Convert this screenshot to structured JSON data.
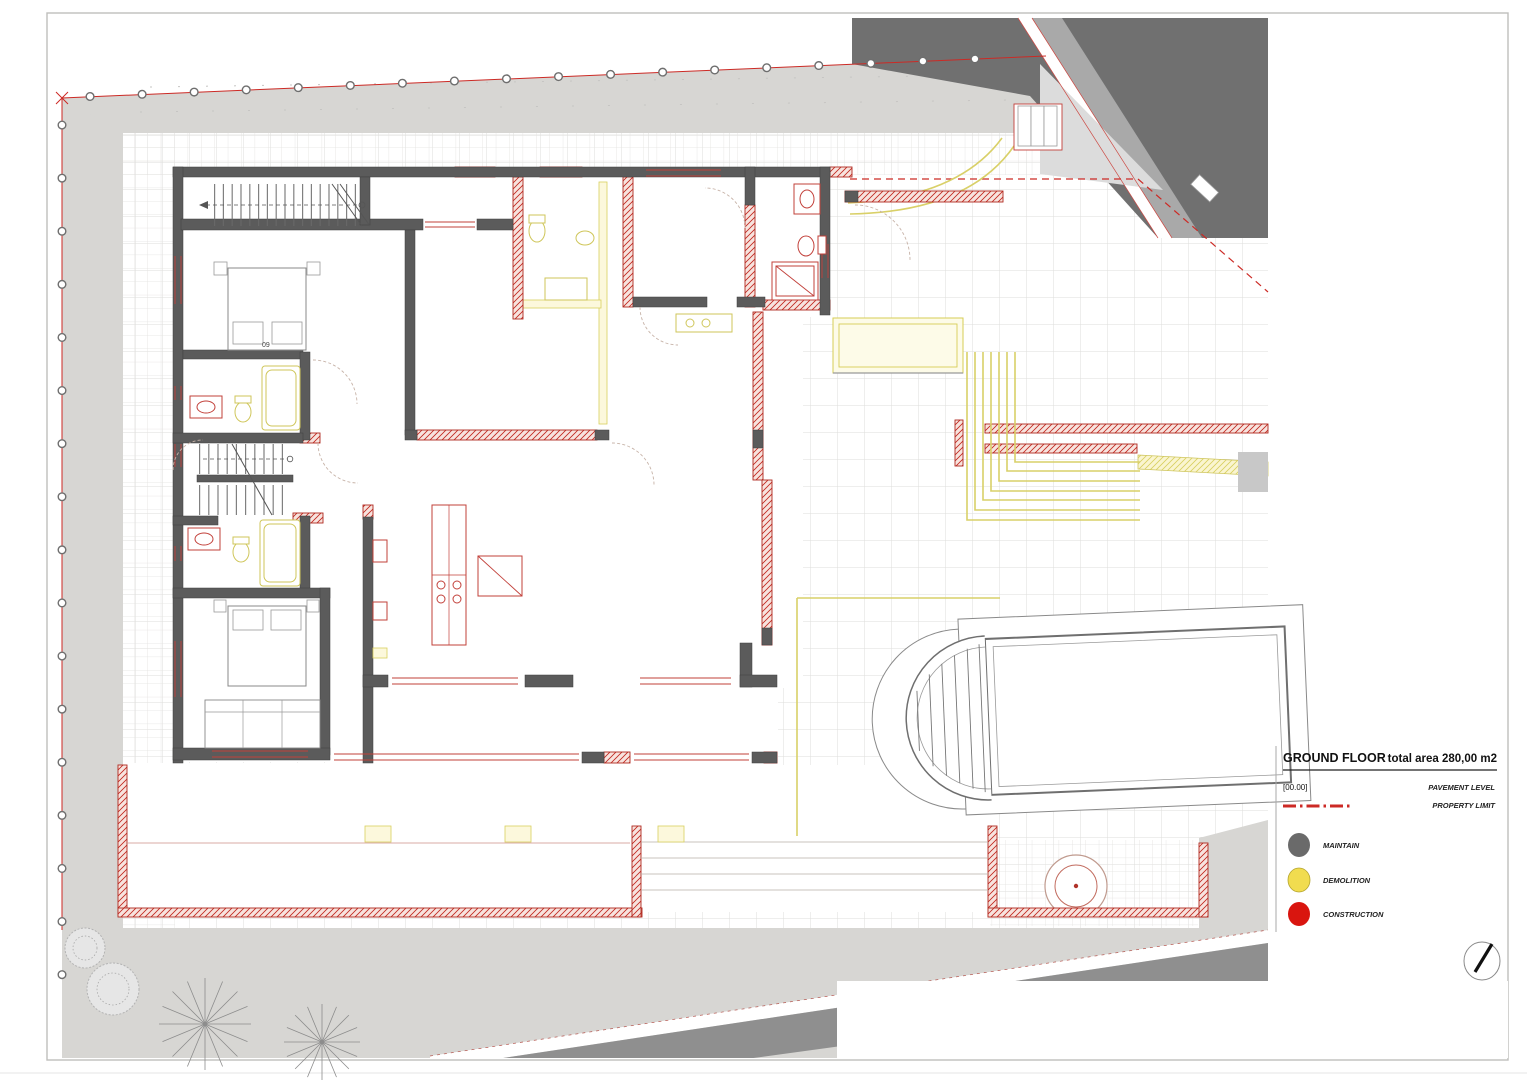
{
  "drawing": {
    "title": "GROUND FLOOR",
    "total_area": "total area 280,00 m2",
    "pavement_code": "[00.00]",
    "pavement_label": "PAVEMENT LEVEL",
    "property_limit_label": "PROPERTY LIMIT",
    "room_number": "09"
  },
  "legend": {
    "items": [
      {
        "id": "maintain",
        "label": "MAINTAIN",
        "color": "#6a6a6a"
      },
      {
        "id": "demolition",
        "label": "DEMOLITION",
        "color": "#f1dc4f"
      },
      {
        "id": "construction",
        "label": "CONSTRUCTION",
        "color": "#d9150f"
      }
    ]
  },
  "colors": {
    "pavement_gray": "#d7d6d3",
    "road_dark": "#707070",
    "road_band": "#a9a9a9",
    "wall_maintain": "#5b5b5b",
    "construction_red": "#c1251c",
    "demolition_yellow": "#d8cf5e",
    "property_line": "#cc2a25",
    "grid_line": "#dedddb"
  }
}
